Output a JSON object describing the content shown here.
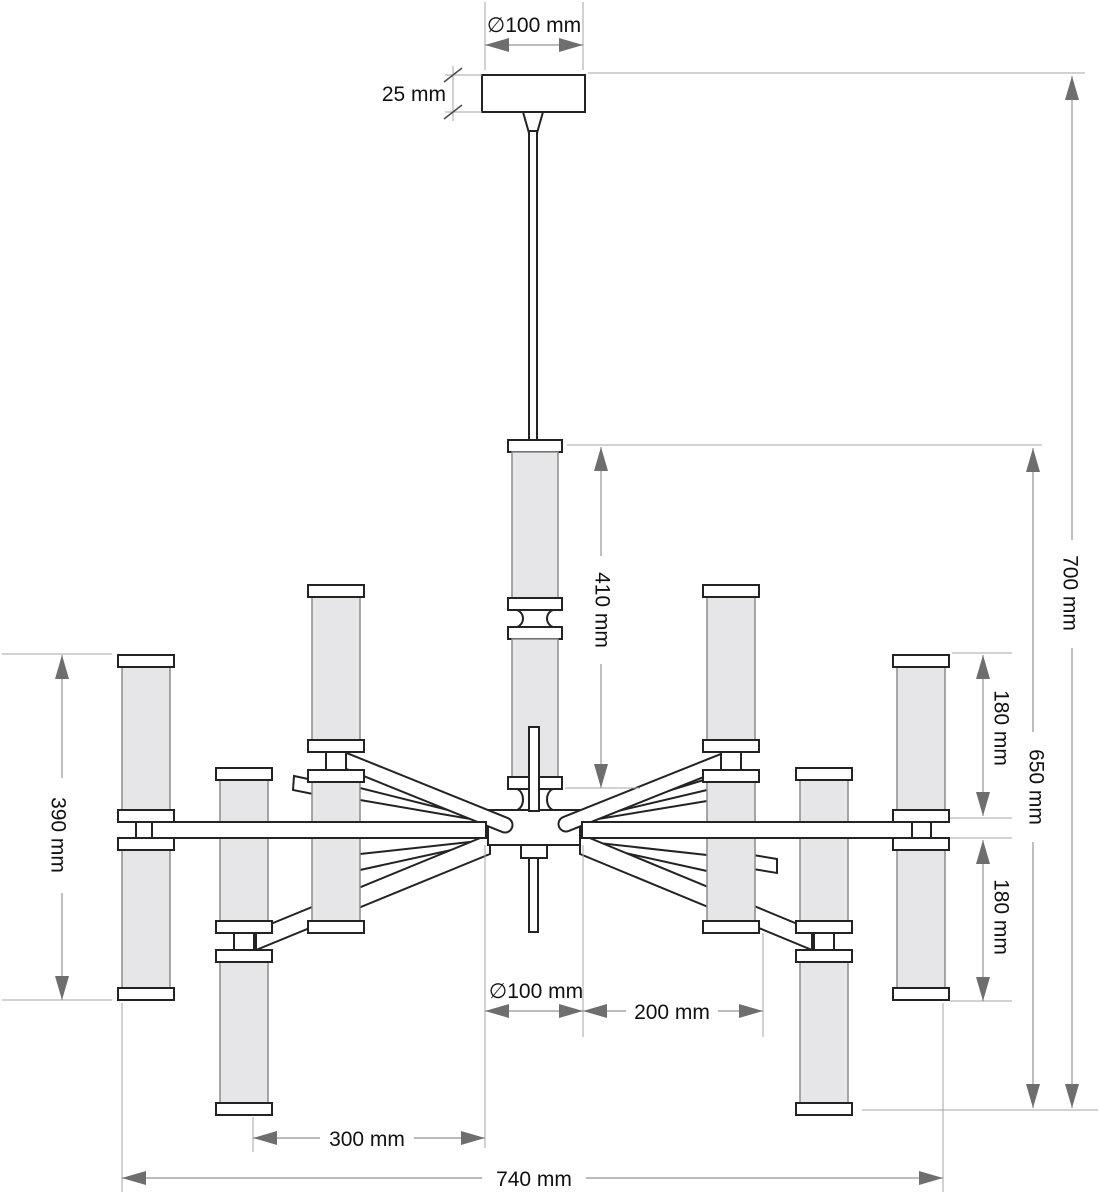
{
  "diagram": {
    "type": "technical-dimension-drawing",
    "subject": "chandelier front elevation with dimensions",
    "units": "mm",
    "labels": {
      "canopy_diameter": "∅100 mm",
      "canopy_height": "25 mm",
      "stem_length": "410 mm",
      "overall_height": "700 mm",
      "body_height": "650 mm",
      "upper_shade_height": "180 mm",
      "lower_shade_height": "180 mm",
      "outer_shade_pair_height": "390 mm",
      "hub_diameter": "∅100 mm",
      "inner_arm_length": "200 mm",
      "mid_arm_length": "300 mm",
      "overall_width": "740 mm"
    },
    "dimensions": [
      {
        "id": "canopy_diameter",
        "value_mm": 100,
        "kind": "diameter",
        "orientation": "horizontal"
      },
      {
        "id": "canopy_height",
        "value_mm": 25,
        "kind": "linear",
        "orientation": "vertical"
      },
      {
        "id": "stem_length",
        "value_mm": 410,
        "kind": "linear",
        "orientation": "vertical"
      },
      {
        "id": "overall_height",
        "value_mm": 700,
        "kind": "linear",
        "orientation": "vertical"
      },
      {
        "id": "body_height",
        "value_mm": 650,
        "kind": "linear",
        "orientation": "vertical"
      },
      {
        "id": "upper_shade_height",
        "value_mm": 180,
        "kind": "linear",
        "orientation": "vertical"
      },
      {
        "id": "lower_shade_height",
        "value_mm": 180,
        "kind": "linear",
        "orientation": "vertical"
      },
      {
        "id": "outer_shade_pair_height",
        "value_mm": 390,
        "kind": "linear",
        "orientation": "vertical"
      },
      {
        "id": "hub_diameter",
        "value_mm": 100,
        "kind": "diameter",
        "orientation": "horizontal"
      },
      {
        "id": "inner_arm_length",
        "value_mm": 200,
        "kind": "linear",
        "orientation": "horizontal"
      },
      {
        "id": "mid_arm_length",
        "value_mm": 300,
        "kind": "linear",
        "orientation": "horizontal"
      },
      {
        "id": "overall_width",
        "value_mm": 740,
        "kind": "linear",
        "orientation": "horizontal"
      }
    ],
    "colors": {
      "background": "#ffffff",
      "outline": "#232323",
      "tube_fill": "#e6e6e8",
      "tube_edge": "#8c8c8c",
      "dimension_line": "#949494",
      "extension_line": "#a6a6a6",
      "arrow": "#6e6e6e",
      "text": "#111111"
    }
  }
}
